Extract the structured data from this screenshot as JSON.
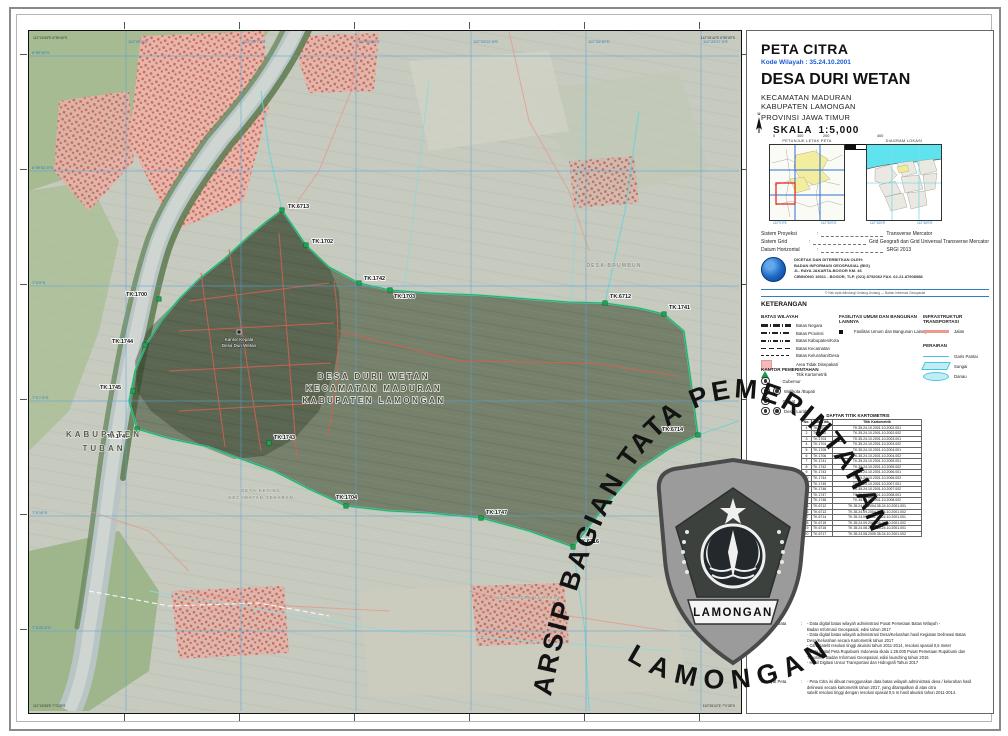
{
  "punct": {
    "colon": ":"
  },
  "title_block": {
    "map_type": "PETA CITRA",
    "kode_wilayah": "Kode Wilayah : 35.24.10.2001",
    "village": "DESA DURI WETAN",
    "district": "KECAMATAN MADURAN",
    "regency": "KABUPATEN LAMONGAN",
    "province": "PROVINSI JAWA TIMUR",
    "north_label": "U",
    "scale_label": "SKALA",
    "scale_value": "1:5,000",
    "scalebar_ticks": [
      "0",
      "100",
      "200",
      "400"
    ],
    "scalebar_unit": "Meter"
  },
  "insets": {
    "left_title": "PETUNJUK LETAK PETA",
    "right_title": "DIAGRAM LOKASI",
    "left_ticks": [
      "112°0'0″E",
      "112°30'0″E"
    ],
    "right_ticks": [
      "112°15'0″E",
      "112°45'0″E"
    ]
  },
  "projection": {
    "rows": [
      {
        "label": "Sistem Proyeksi",
        "value": "Transverse Mercator"
      },
      {
        "label": "Sistem Grid",
        "value": "Grid Geografi dan Grid Universal Transverse Mercator"
      },
      {
        "label": "Datum Horizontal",
        "value": "SRGI 2013"
      }
    ]
  },
  "publisher": {
    "line1": "DICETAK DAN DITERBITKAN OLEH:",
    "line2": "BADAN INFORMASI GEOSPASIAL (BIG)",
    "line3": "JL. RAYA JAKARTA-BOGOR KM. 46",
    "line4": "CIBINONG 16911 - BOGOR, TLP. (021) 8752062 FAX. 62-21-87908988",
    "copyright": "© Hak cipta dilindungi Undang-Undang — Badan Informasi Geospasial"
  },
  "legend": {
    "title": "KETERANGAN",
    "batas_title": "BATAS WILAYAH",
    "batas_items": [
      "Batas Negara",
      "Batas Provinsi",
      "Batas Kabupaten/Kota",
      "Batas Kecamatan",
      "Batas Kelurahan/Desa",
      "Area Tidak Disepakati",
      "Titik Kartometrik"
    ],
    "fasilitas_title": "FASILITAS UMUM DAN BANGUNAN LAINNYA",
    "fasilitas_item": "Fasilitas Umum dan Bangunan Lainnya",
    "infra_title": "INFRASTRUKTUR TRANSPORTASI",
    "infra_item": "Jalan",
    "perairan_title": "PERAIRAN",
    "perairan_items": [
      "Garis Pantai",
      "Sungai",
      "Danau"
    ],
    "kantor_title": "KANTOR PEMERINTAHAN",
    "kantor_items": [
      "Gubernur",
      "Walikota /Bupati",
      "Camat",
      "Desa, Lurah"
    ]
  },
  "table": {
    "title": "DAFTAR TITIK KARTOMETRIS",
    "headers": [
      "No.",
      "No. Titik",
      "Titik Kartometrik"
    ],
    "rows": [
      [
        "1",
        "TK.1700",
        "TK.35.24.10.2001.10.2002.001"
      ],
      [
        "2",
        "TK.1702",
        "TK.35.24.10.2001.10.2002.002"
      ],
      [
        "3",
        "TK.1703",
        "TK.35.24.10.2001.10.2003.001"
      ],
      [
        "4",
        "TK.1704",
        "TK.35.24.10.2001.10.2003.002"
      ],
      [
        "5",
        "TK.1705",
        "TK.35.24.10.2001.10.2004.001"
      ],
      [
        "6",
        "TK.1706",
        "TK.35.24.10.2001.10.2004.002"
      ],
      [
        "7",
        "TK.1741",
        "TK.35.24.10.2001.10.2005.001"
      ],
      [
        "8",
        "TK.1742",
        "TK.35.24.10.2001.10.2005.002"
      ],
      [
        "9",
        "TK.1743",
        "TK.35.24.10.2001.10.2006.001"
      ],
      [
        "10",
        "TK.1744",
        "TK.35.24.10.2001.10.2006.002"
      ],
      [
        "11",
        "TK.1745",
        "TK.35.24.10.2001.10.2007.001"
      ],
      [
        "12",
        "TK.1746",
        "TK.35.24.10.2001.10.2007.002"
      ],
      [
        "13",
        "TK.1747",
        "TK.35.24.10.2001.10.2008.001"
      ],
      [
        "14",
        "TK.1748",
        "TK.35.24.10.2001.10.2008.002"
      ],
      [
        "15",
        "TK.6712",
        "TK.35.24.09.2004.35.24.10.2001.001"
      ],
      [
        "16",
        "TK.6713",
        "TK.35.24.09.2004.35.24.10.2001.002"
      ],
      [
        "17",
        "TK.6714",
        "TK.35.24.09.2001.35.24.10.2001.001"
      ],
      [
        "18",
        "TK.6715",
        "TK.35.24.09.2001.35.24.10.2001.002"
      ],
      [
        "19",
        "TK.6716",
        "TK.35.24.08.2005.35.24.10.2001.001"
      ],
      [
        "20",
        "TK.6717",
        "TK.35.24.08.2005.35.24.10.2001.002"
      ]
    ]
  },
  "notes": {
    "sumber_label": "Sumber Data",
    "sumber_lines": [
      "- Data digital batas wilayah administrasi Pusat Pemetaan Batas Wilayah -",
      "  Badan Informasi Geospasial, edisi tahun 2017",
      "- Data digital batas wilayah administrasi Desa/Kelurahan hasil Kegiatan Delineasi Batas",
      "  Desa/Kelurahan secara Kartometrik tahun 2017",
      "- Citra satelit resolusi tinggi akuisisi tahun 2011-2014, resolusi spasial 0,5 meter",
      "- Data digital Peta Rupabumi Indonesia skala 1:25.000 Pusat Pemetaan Rupabumi dan",
      "  Toponim - Badan Informasi Geospasial, edisi launching tahun 2016",
      "- Hasil Digitasi Unsur Transportasi dan Hidrografi Tahun 2017"
    ],
    "riwayat_label": "Riwayat Peta",
    "riwayat_lines": [
      "- Peta Citra ini dibuat menggunakan data batas wilayah administrasi desa / kelurahan hasil",
      "  delineasi secara kartometrik tahun 2017, yang ditampalkan di atas citra",
      "  satelit resolusi tinggi dengan resolusi spasial 0,5 m hasil akuisisi tahun 2011-2014."
    ]
  },
  "map": {
    "labels": {
      "kabupaten_tuban_line1": "KABUPATEN",
      "kabupaten_tuban_line2": "TUBAN",
      "village_line1": "DESA DURI WETAN",
      "village_line2": "KECAMATAN MADURAN",
      "village_line3": "KABUPATEN LAMONGAN",
      "office_line1": "Kantor Kepala",
      "office_line2": "Desa Duri Wetan",
      "neighbor_north": "DESA BRUMBUN",
      "neighbor_sw_line1": "DESA KETING",
      "neighbor_sw_line2": "KECAMATAN SEKARAN",
      "neighbor_south": "KECAMATAN SEKARAN"
    },
    "markers": [
      {
        "id": "TK.6713",
        "x": 253,
        "y": 179,
        "dx": 6,
        "dy": -2
      },
      {
        "id": "TK.1702",
        "x": 277,
        "y": 214,
        "dx": 6,
        "dy": -2
      },
      {
        "id": "TK.1742",
        "x": 330,
        "y": 252,
        "dx": 5,
        "dy": -3
      },
      {
        "id": "TK.1703",
        "x": 361,
        "y": 259,
        "dx": 4,
        "dy": 8
      },
      {
        "id": "TK.1700",
        "x": 130,
        "y": 268,
        "dx": -33,
        "dy": -3
      },
      {
        "id": "TK.1744",
        "x": 116,
        "y": 314,
        "dx": -33,
        "dy": -2
      },
      {
        "id": "TK.1745",
        "x": 104,
        "y": 360,
        "dx": -33,
        "dy": -2
      },
      {
        "id": "TK.1746",
        "x": 108,
        "y": 398,
        "dx": -30,
        "dy": 9
      },
      {
        "id": "TK.1743",
        "x": 240,
        "y": 412,
        "dx": 5,
        "dy": -4
      },
      {
        "id": "TK.1704",
        "x": 317,
        "y": 475,
        "dx": -10,
        "dy": -7
      },
      {
        "id": "TK.1747",
        "x": 452,
        "y": 487,
        "dx": 5,
        "dy": -4
      },
      {
        "id": "TK.6716",
        "x": 544,
        "y": 516,
        "dx": 5,
        "dy": -4
      },
      {
        "id": "TK.6712",
        "x": 576,
        "y": 272,
        "dx": 5,
        "dy": -5
      },
      {
        "id": "TK.1741",
        "x": 635,
        "y": 283,
        "dx": 5,
        "dy": -5
      },
      {
        "id": "TK.6714",
        "x": 669,
        "y": 404,
        "dx": -36,
        "dy": -4
      }
    ],
    "grid": {
      "lon_labels": [
        "112°25'0″E",
        "112°25'7.5″E",
        "112°25'15″E",
        "112°25'22.5″E",
        "112°25'30″E",
        "112°25'37.5″E"
      ],
      "lat_labels": [
        "6°59'45″S",
        "6°59'52.5″S",
        "7°0'0″S",
        "7°0'7.5″S",
        "7°0'15″S",
        "7°0'22.5″S"
      ]
    },
    "corners": {
      "tl": "112°24'55″E 6°59'40″S",
      "tr": "112°25'42″E 6°59'40″S",
      "bl": "112°24'55″E 7°0'28″S",
      "br": "112°25'42″E 7°0'28″S"
    }
  },
  "watermark": {
    "arc_text": "ARSIP BAGIAN TATA PEMERINTAHAN",
    "bottom_text": "LAMONGAN",
    "shield_banner": "LAMONGAN"
  }
}
